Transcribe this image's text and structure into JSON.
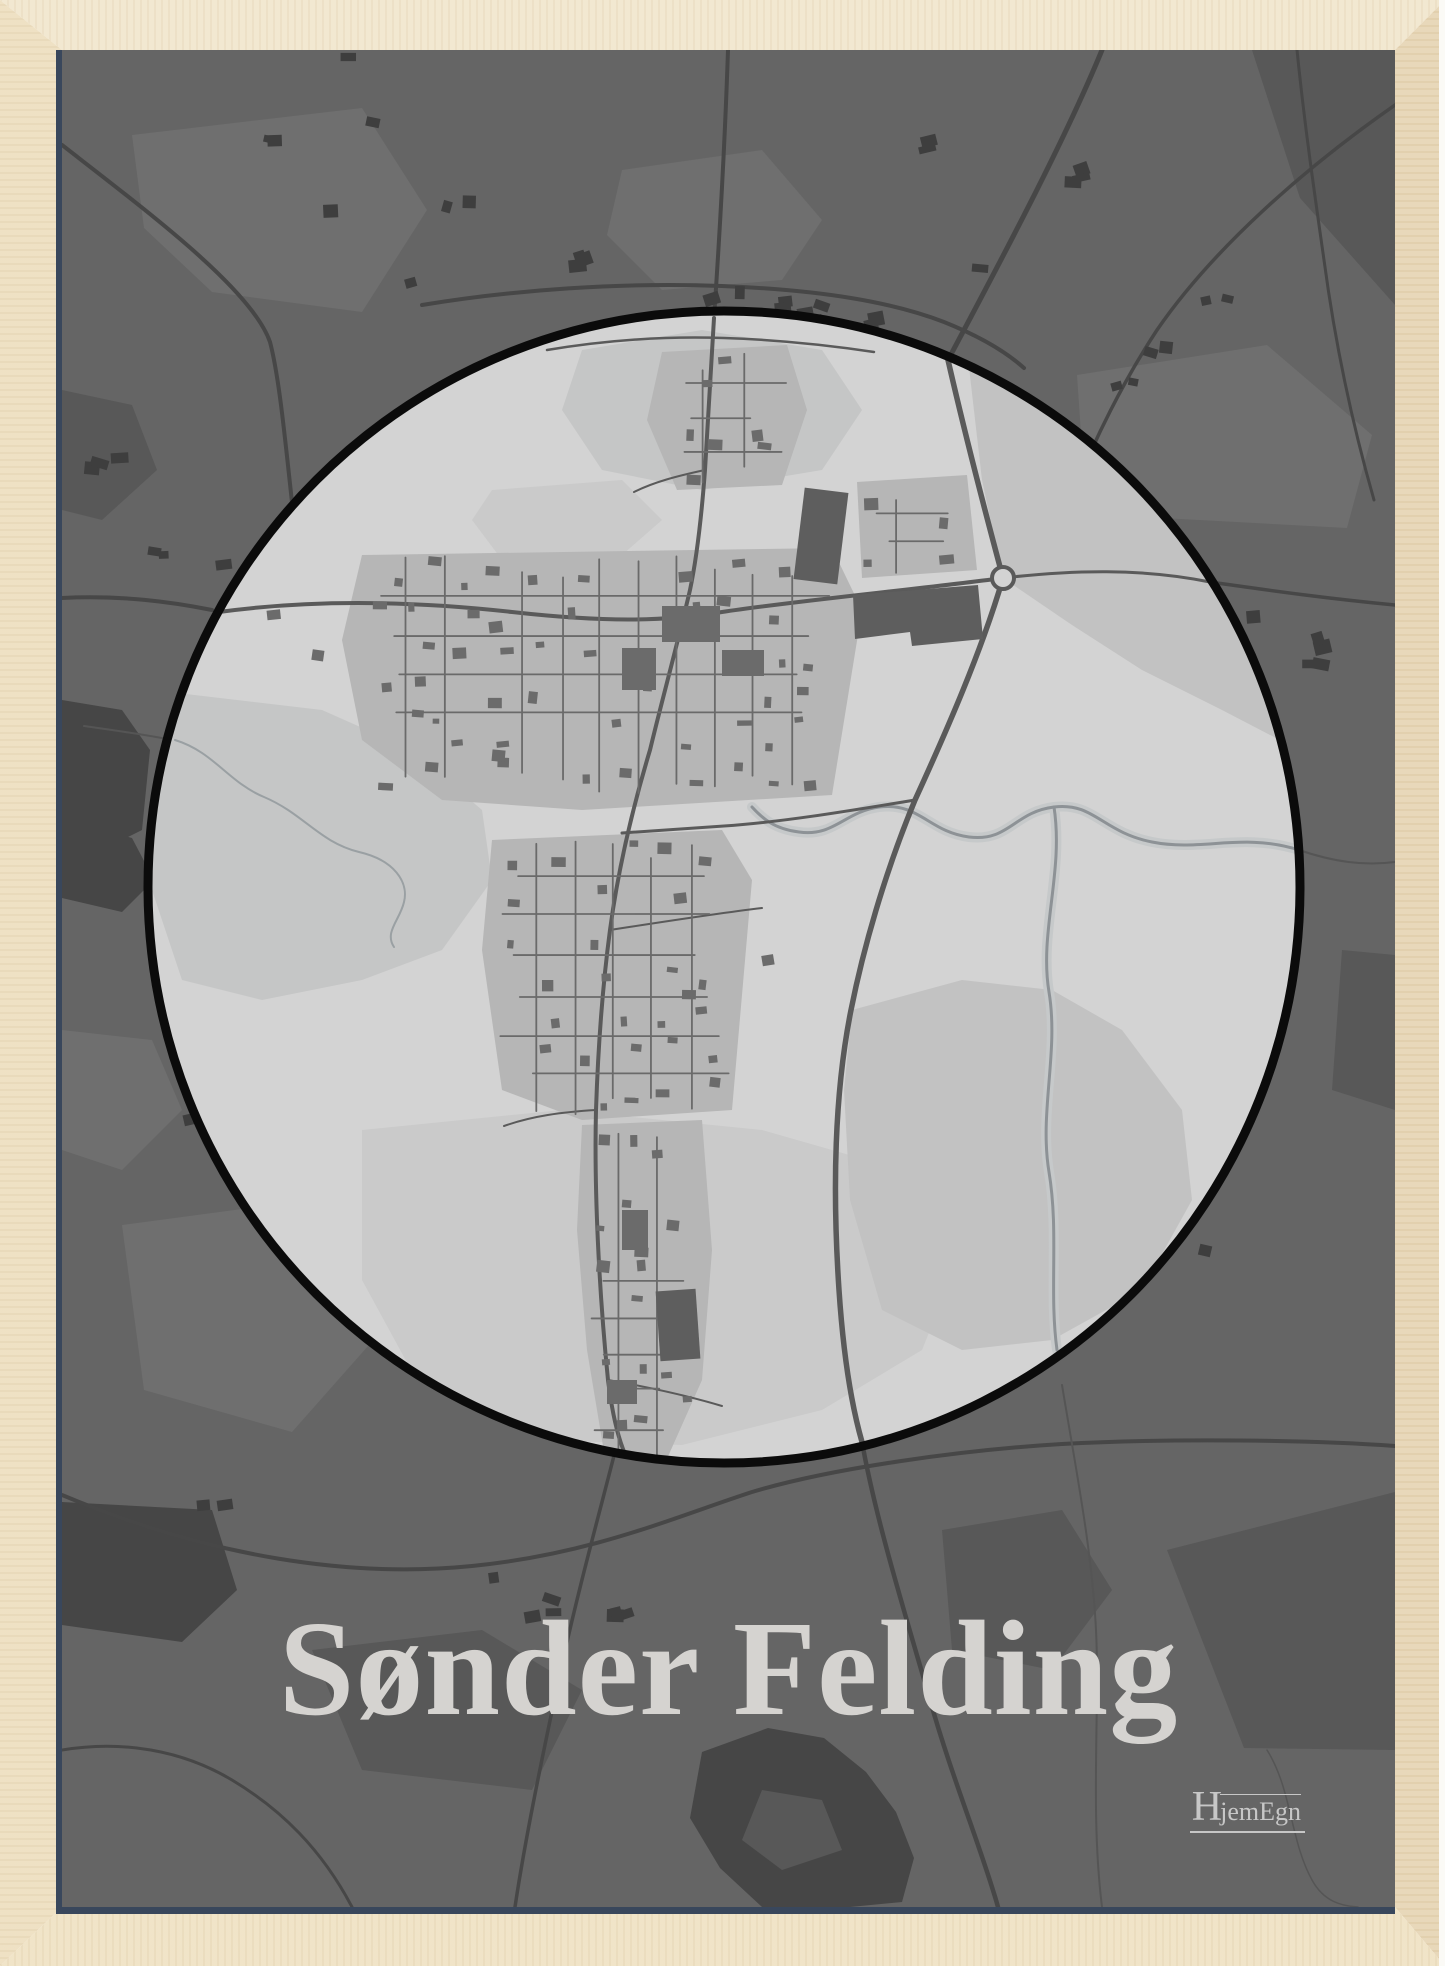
{
  "poster": {
    "title": "Sønder Felding",
    "brand": {
      "initial": "H",
      "rest": "jemEgn",
      "full": "HjemEgn"
    }
  },
  "map": {
    "place_name": "Sønder Felding",
    "style": "grayscale street map poster",
    "focus_shape": "circular town inset",
    "features": [
      "town-circle",
      "roundabout",
      "main-road",
      "river",
      "residential-blocks",
      "lake",
      "countryside-fields"
    ]
  },
  "colors": {
    "frame_light": "#f2e7cf",
    "frame_mid": "#eee0c2",
    "frame_dark": "#e7d6b6",
    "frame_bottom": "#f0e3c6",
    "frame_edge": "#fbfaf6",
    "glass_shadow": "#39475c",
    "map_dark_bg": "#656565",
    "map_dark_field_light": "#6f6f6f",
    "map_dark_field_dark": "#585858",
    "map_dark_road": "#474747",
    "map_dark_building": "#3e3e3e",
    "map_dark_water": "#464646",
    "circle_bg": "#d3d3d3",
    "circle_field": "#c5c6c6",
    "circle_field2": "#cacaca",
    "circle_med": "#c2c2c2",
    "circle_block": "#b6b6b6",
    "circle_road": "#5a5a5a",
    "circle_street": "#6a6a6a",
    "circle_building": "#6b6b6b",
    "circle_dark_patch": "#5e5e5e",
    "river_line": "#8d9296",
    "river_halo": "#c6c9ca",
    "circle_border": "#0b0b0b",
    "title_text": "#d5d3d0",
    "brand_text": "#c7c7c7"
  }
}
